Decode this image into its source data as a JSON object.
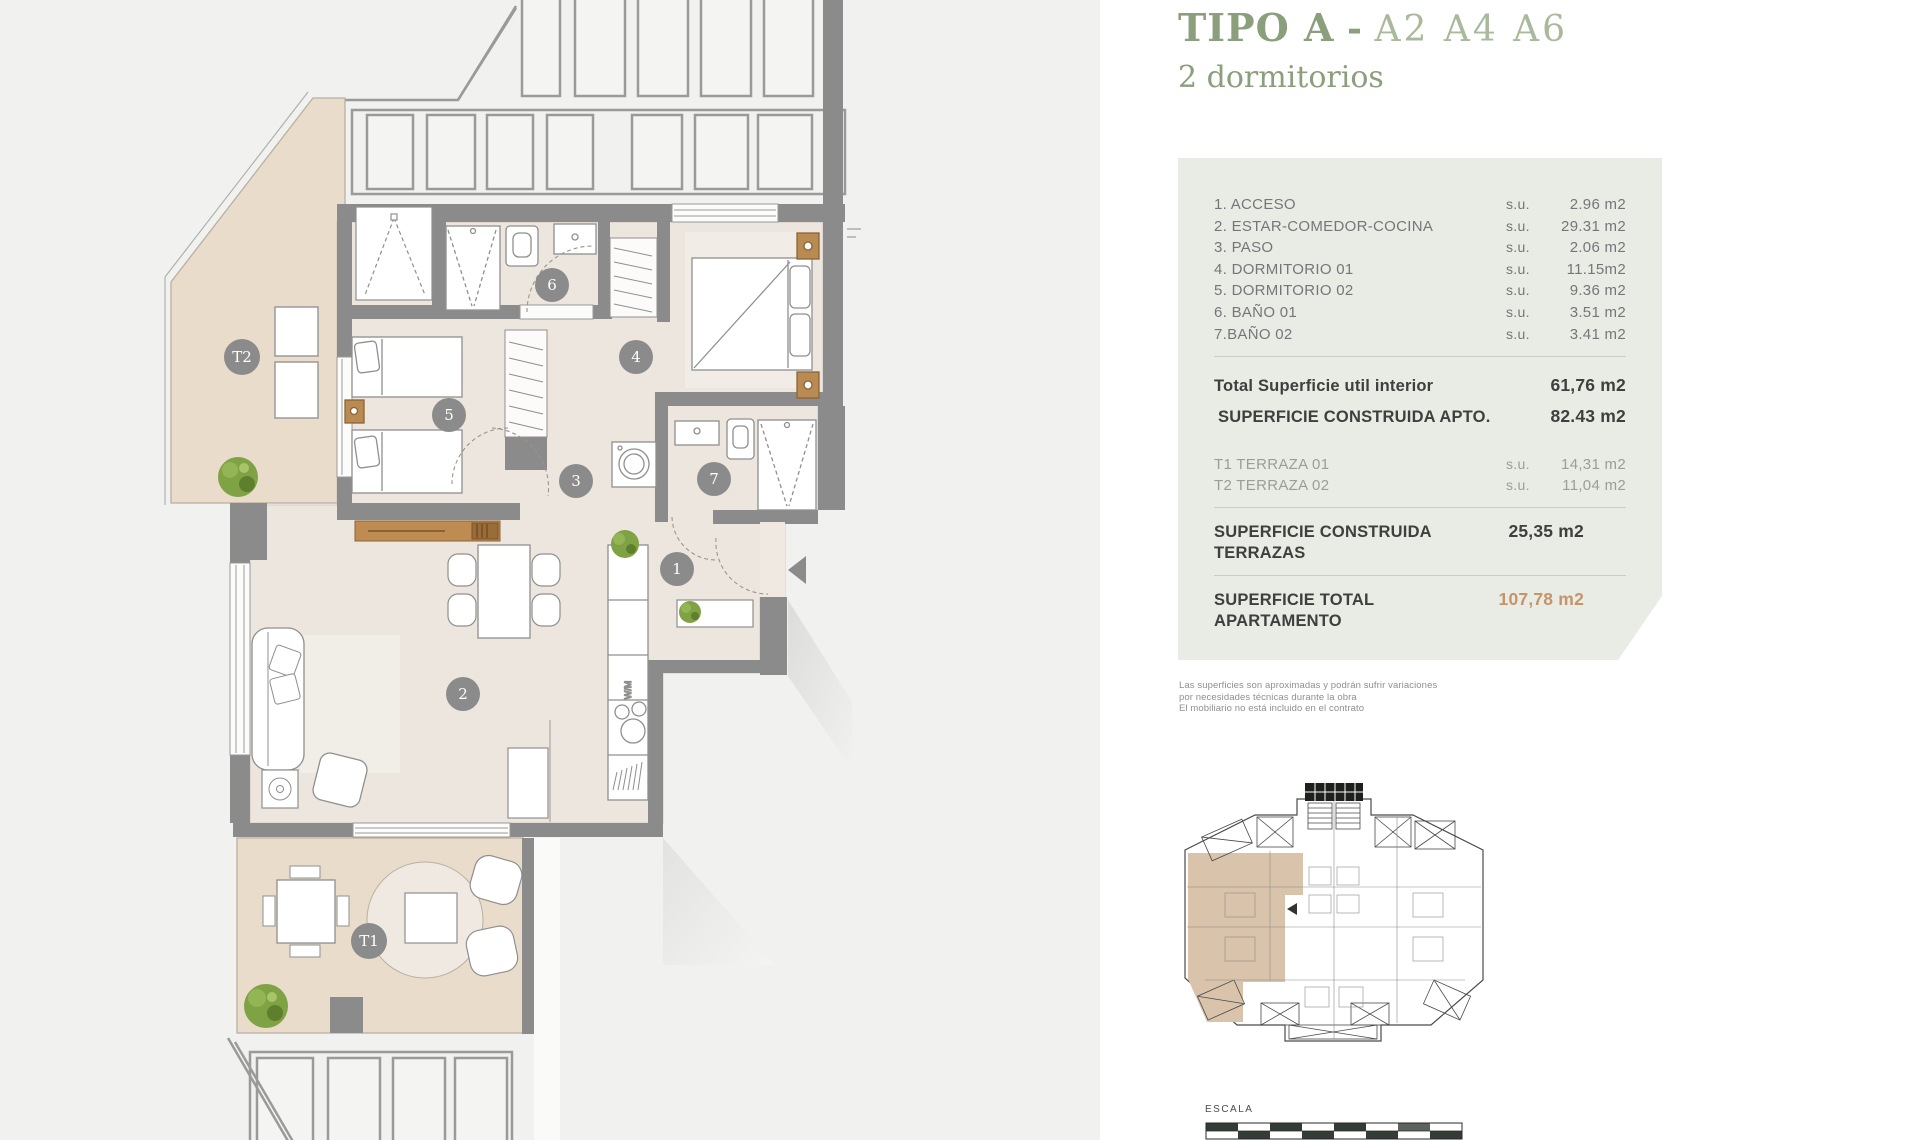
{
  "title": {
    "main": "TIPO A",
    "separator": " - ",
    "units": "A2 A4 A6",
    "subtitle": "2 dormitorios"
  },
  "panel": {
    "rooms": [
      {
        "label": "1. ACCESO",
        "prefix": "s.u.",
        "value": "2.96 m2"
      },
      {
        "label": "2. ESTAR-COMEDOR-COCINA",
        "prefix": "s.u.",
        "value": "29.31 m2"
      },
      {
        "label": "3. PASO",
        "prefix": "s.u.",
        "value": "2.06 m2"
      },
      {
        "label": "4. DORMITORIO 01",
        "prefix": "s.u.",
        "value": "11.15m2"
      },
      {
        "label": "5. DORMITORIO 02",
        "prefix": "s.u.",
        "value": "9.36 m2"
      },
      {
        "label": "6. BAÑO 01",
        "prefix": "s.u.",
        "value": "3.51 m2"
      },
      {
        "label": "7.BAÑO 02",
        "prefix": "s.u.",
        "value": "3.41 m2"
      }
    ],
    "totals": [
      {
        "label": "Total Superficie util interior",
        "value": "61,76 m2"
      },
      {
        "label": "SUPERFICIE CONSTRUIDA APTO.",
        "value": "82.43 m2"
      }
    ],
    "terraces": [
      {
        "label": "T1 TERRAZA 01",
        "prefix": "s.u.",
        "value": "14,31 m2"
      },
      {
        "label": "T2 TERRAZA 02",
        "prefix": "s.u.",
        "value": "11,04 m2"
      }
    ],
    "terrace_total": {
      "label": "SUPERFICIE CONSTRUIDA TERRAZAS",
      "value": "25,35 m2"
    },
    "grand_total": {
      "label": "SUPERFICIE TOTAL APARTAMENTO",
      "value": "107,78 m2"
    }
  },
  "disclaimer": {
    "line1": "Las superficies son aproximadas y podrán sufrir variaciones",
    "line2": "por necesidades técnicas durante la obra",
    "line3": "El mobiliario no está incluido en el contrato"
  },
  "scale": {
    "label": "ESCALA"
  },
  "plan": {
    "markers": {
      "r1": "1",
      "r2": "2",
      "r3": "3",
      "r4": "4",
      "r5": "5",
      "r6": "6",
      "r7": "7",
      "t1": "T1",
      "t2": "T2"
    },
    "washer_label": "W/M"
  },
  "colors": {
    "title_green": "#8b9f7c",
    "units_green": "#a9b99b",
    "panel_bg": "#e8ece4",
    "total_accent": "#c7946a",
    "wall_gray": "#8b8b8b",
    "floor_beige": "#ece6df",
    "terrace_tan": "#e9dccb",
    "plant_green": "#7fa244"
  }
}
